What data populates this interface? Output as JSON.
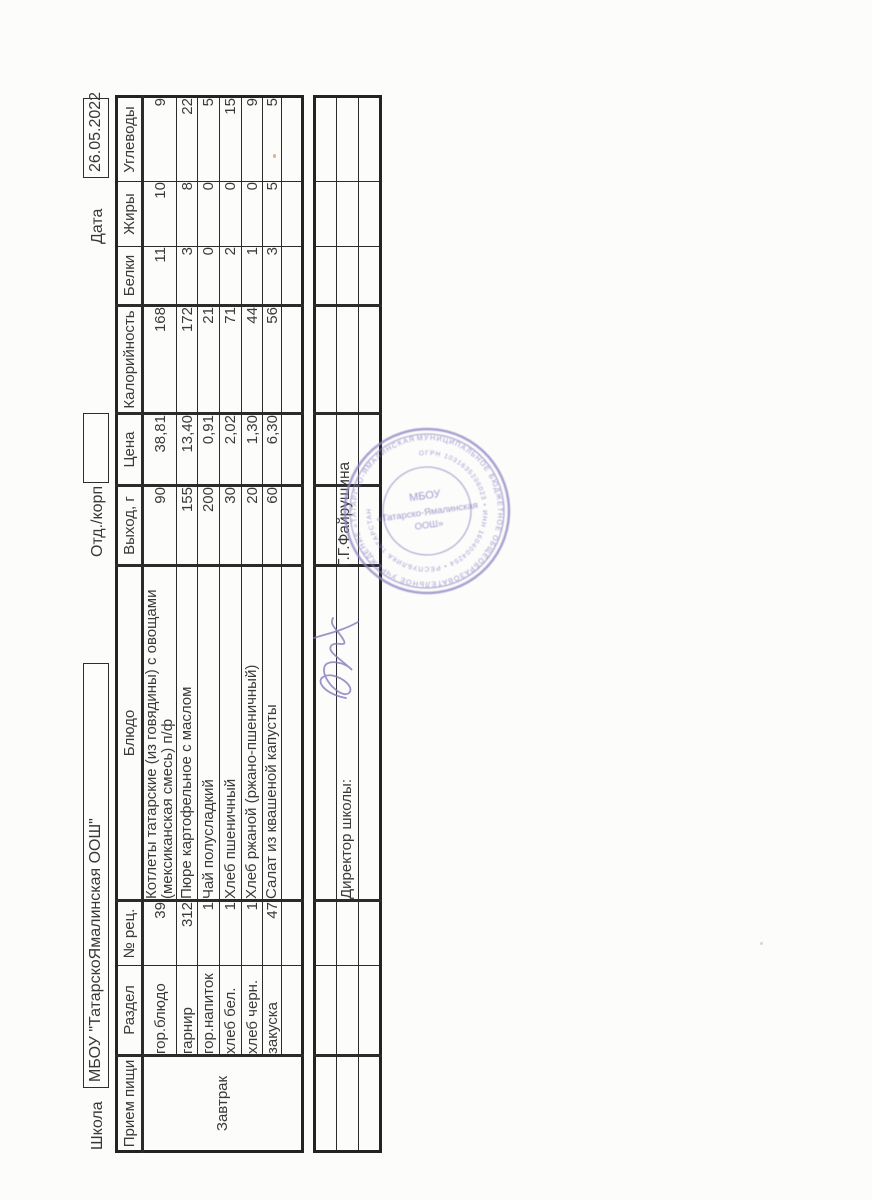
{
  "page": {
    "school_label": "Школа",
    "school_name": "МБОУ \"ТатарскоЯмалинская ООШ\"",
    "dept_label": "Отд./корп",
    "dept_value": "",
    "date_label": "Дата",
    "date_value": "26.05.2022"
  },
  "menu_table": {
    "columns": [
      "Прием пищи",
      "Раздел",
      "№ рец.",
      "Блюдо",
      "Выход, г",
      "Цена",
      "Калорийность",
      "Белки",
      "Жиры",
      "Углеводы"
    ],
    "meal": "Завтрак",
    "rows": [
      {
        "section": "гор.блюдо",
        "rec": "39",
        "dish": "Котлеты татарские (из говядины) с овощами (мексиканская смесь) п/ф",
        "out": "90",
        "price": "38,81",
        "kcal": "168",
        "protein": "11",
        "fat": "10",
        "carbs": "9"
      },
      {
        "section": "гарнир",
        "rec": "312",
        "dish": "Пюре картофельное с маслом",
        "out": "155",
        "price": "13,40",
        "kcal": "172",
        "protein": "3",
        "fat": "8",
        "carbs": "22"
      },
      {
        "section": "гор.напиток",
        "rec": "1",
        "dish": "Чай полусладкий",
        "out": "200",
        "price": "0,91",
        "kcal": "21",
        "protein": "0",
        "fat": "0",
        "carbs": "5"
      },
      {
        "section": "хлеб бел.",
        "rec": "1",
        "dish": "Хлеб пшеничный",
        "out": "30",
        "price": "2,02",
        "kcal": "71",
        "protein": "2",
        "fat": "0",
        "carbs": "15"
      },
      {
        "section": "хлеб черн.",
        "rec": "1",
        "dish": "Хлеб ржаной (ржано-пшеничный)",
        "out": "20",
        "price": "1,30",
        "kcal": "44",
        "protein": "1",
        "fat": "0",
        "carbs": "9"
      },
      {
        "section": "закуска",
        "rec": "47",
        "dish": "Салат из квашеной капусты",
        "out": "60",
        "price": "6,30",
        "kcal": "56",
        "protein": "3",
        "fat": "5",
        "carbs": "5"
      }
    ]
  },
  "footer": {
    "director_label": "Директор школы:",
    "director_name": "Г.Г.Файрушина"
  },
  "stamp": {
    "ring_top": "МУНИЦИПАЛЬНОЕ БЮДЖЕТНОЕ ОБЩЕОБРАЗОВАТЕЛЬНОЕ УЧРЕЖДЕНИЕ «ТАТАРСКО-ЯМАЛИНСКАЯ ООШ»",
    "ring_inner": "ОГРН 1031635206023 • ИНН 1604004254 • РЕСПУБЛИКА ТАТАРСТАН",
    "center_line1": "МБОУ",
    "center_line2": "«Татарско-Ямалинская",
    "center_line3": "ООШ»",
    "ink_color": "#8b7ec4"
  }
}
